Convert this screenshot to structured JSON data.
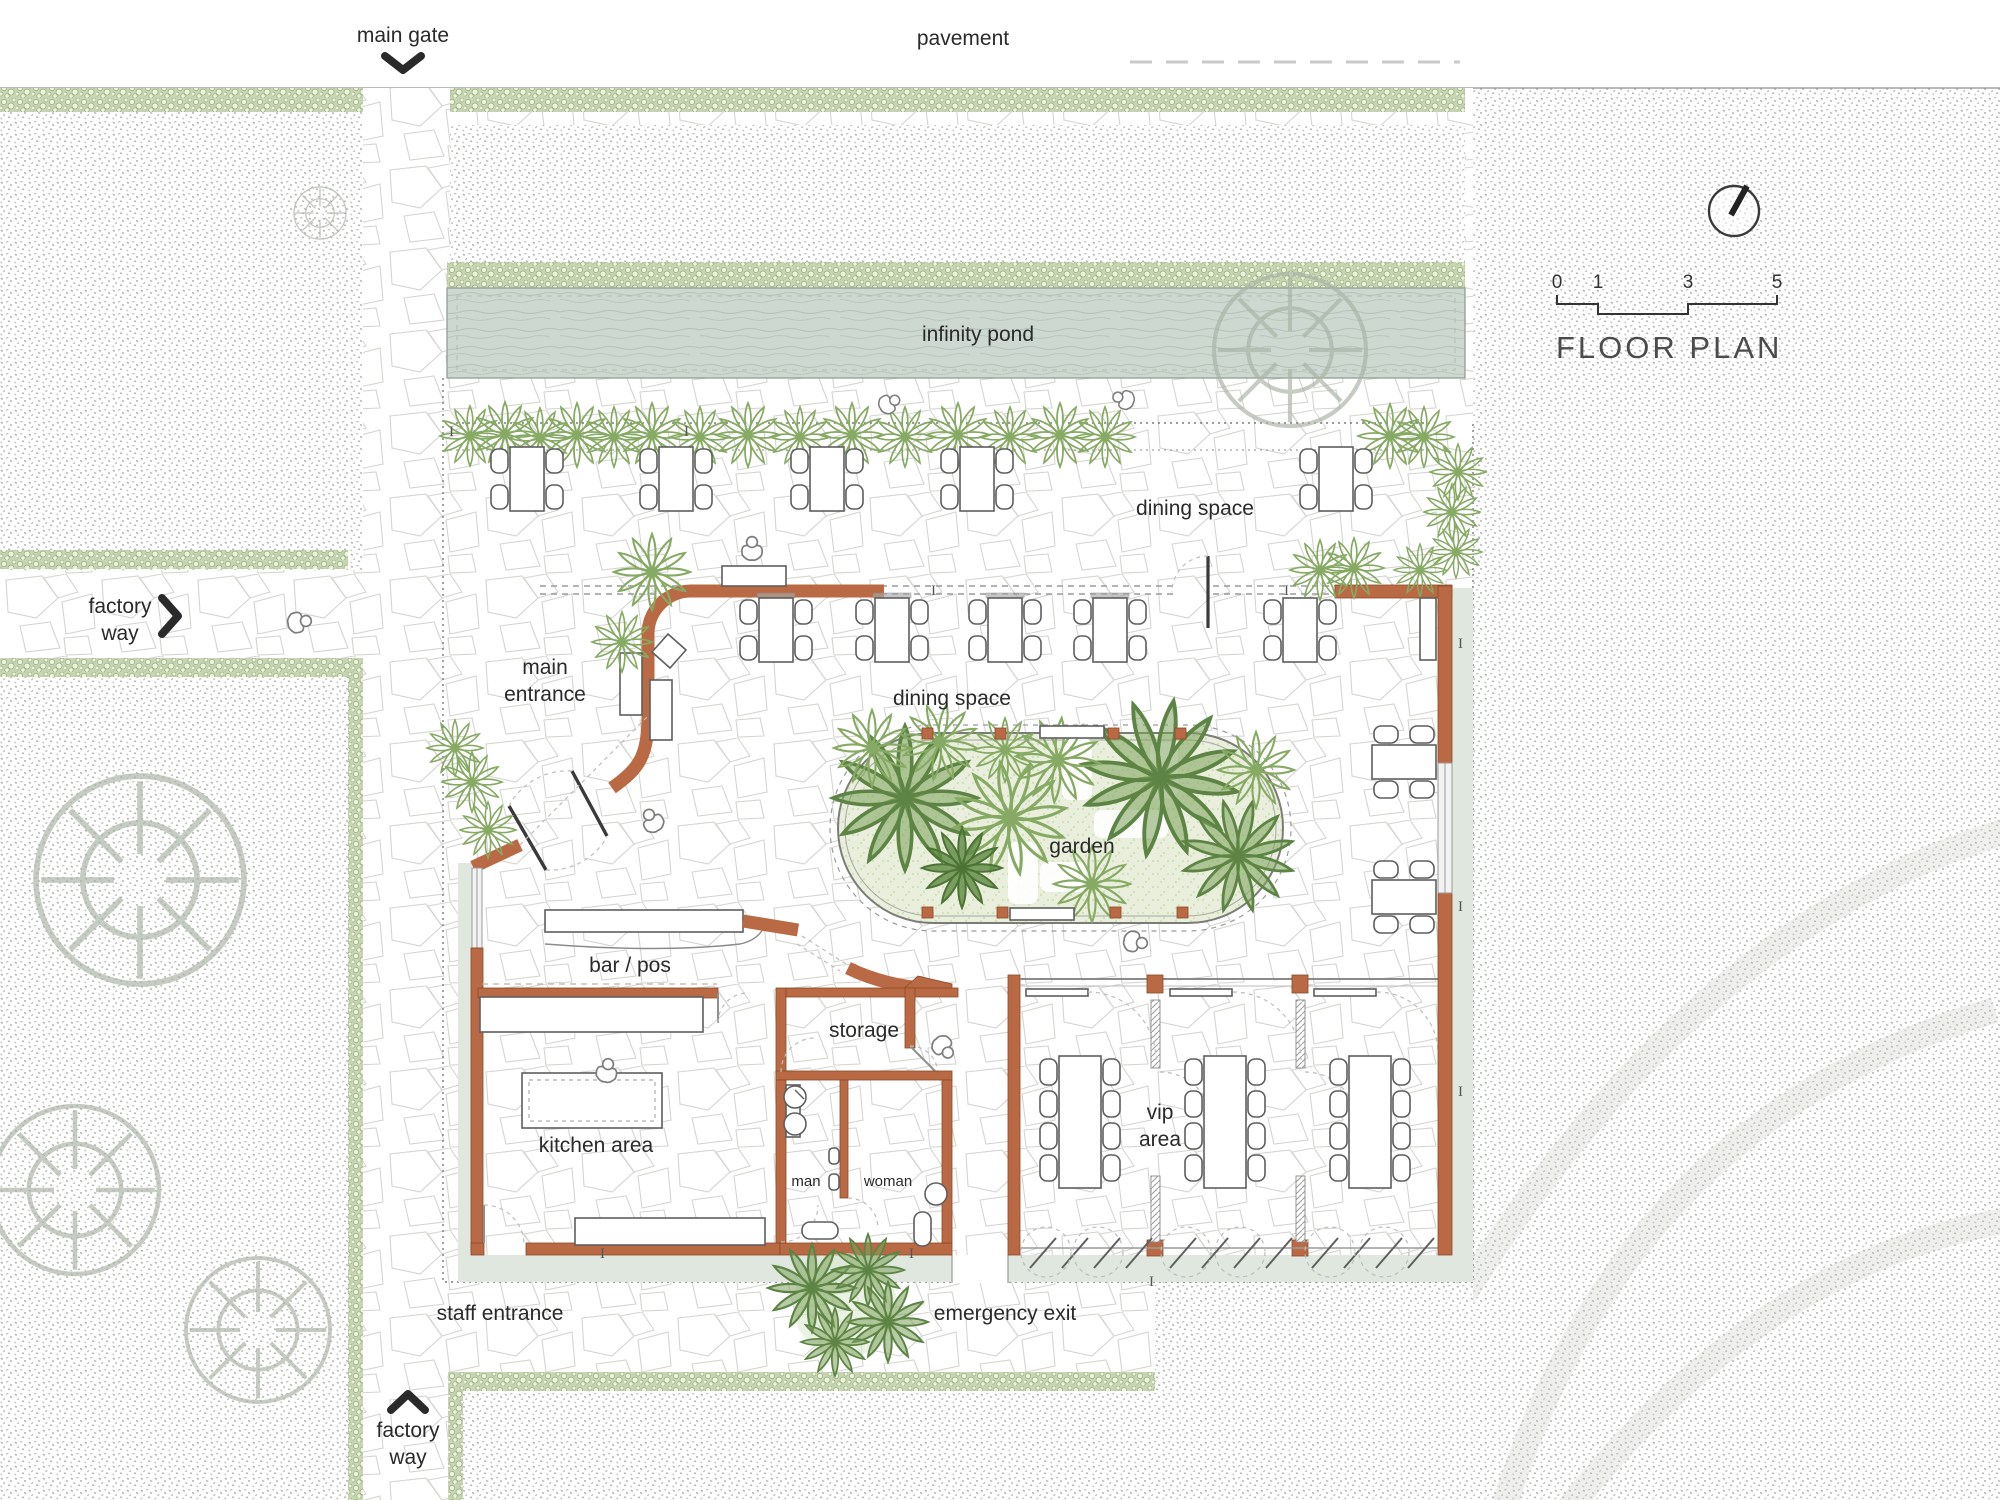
{
  "title": {
    "floor_plan": "FLOOR PLAN"
  },
  "scale_bar": {
    "ticks": [
      "0",
      "1",
      "3",
      "5"
    ]
  },
  "site": {
    "pavement": "pavement",
    "main_gate": "main gate",
    "factory_way": {
      "line1": "factory",
      "line2": "way"
    },
    "infinity_pond": "infinity pond",
    "staff_entrance": "staff entrance",
    "emergency_exit": "emergency exit"
  },
  "rooms": {
    "dining_space": "dining space",
    "main_entrance": {
      "line1": "main",
      "line2": "entrance"
    },
    "garden": "garden",
    "bar": "bar / pos",
    "storage": "storage",
    "kitchen": "kitchen area",
    "man": "man",
    "woman": "woman",
    "vip": {
      "line1": "vip",
      "line2": "area"
    }
  },
  "colors": {
    "wall": "#b96a44",
    "hedge": "#c7d6b2",
    "pond": "#cdd8d1",
    "garden_fill": "#e9efdc",
    "slab": "#dfe7df",
    "ink": "#2a2a2a"
  }
}
